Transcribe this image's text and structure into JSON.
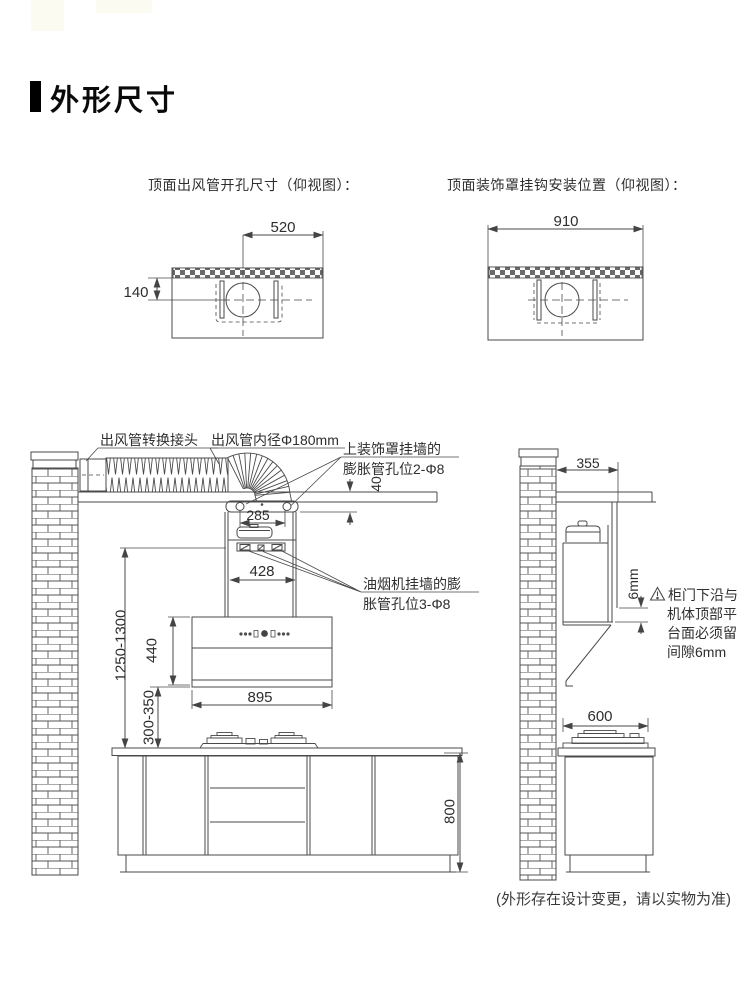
{
  "page": {
    "title": "外形尺寸",
    "footnote": "(外形存在设计变更，请以实物为准)"
  },
  "colors": {
    "line": "#4a4a4a",
    "text": "#2e2e2e",
    "accent": "#000000"
  },
  "top_left_diagram": {
    "title": "顶面出风管开孔尺寸（仰视图）：",
    "dims": {
      "center_to_edge": "520",
      "strip_to_center": "140"
    }
  },
  "top_right_diagram": {
    "title": "顶面装饰罩挂钩安装位置（仰视图）：",
    "dims": {
      "total_width": "910"
    }
  },
  "front_view": {
    "labels": {
      "duct_adapter": "出风管转换接头",
      "duct_diameter": "出风管内径Φ180mm",
      "cover_holes_line1": "上装饰罩挂墙的",
      "cover_holes_line2": "膨胀管孔位2-Φ8",
      "hood_holes_line1": "油烟机挂墙的膨",
      "hood_holes_line2": "胀管孔位3-Φ8"
    },
    "dims": {
      "ceiling_gap": "40",
      "hook_span": "285",
      "chimney_width": "428",
      "install_height": "1250-1300",
      "hood_height": "440",
      "hood_width": "895",
      "hood_to_counter": "300-350",
      "counter_height": "800"
    }
  },
  "side_view": {
    "dims": {
      "top_depth": "355",
      "door_gap": "6mm",
      "stove_depth": "600"
    },
    "warning": {
      "lines": [
        "柜门下沿与",
        "机体顶部平",
        "台面必须留",
        "间隙6mm"
      ]
    }
  }
}
